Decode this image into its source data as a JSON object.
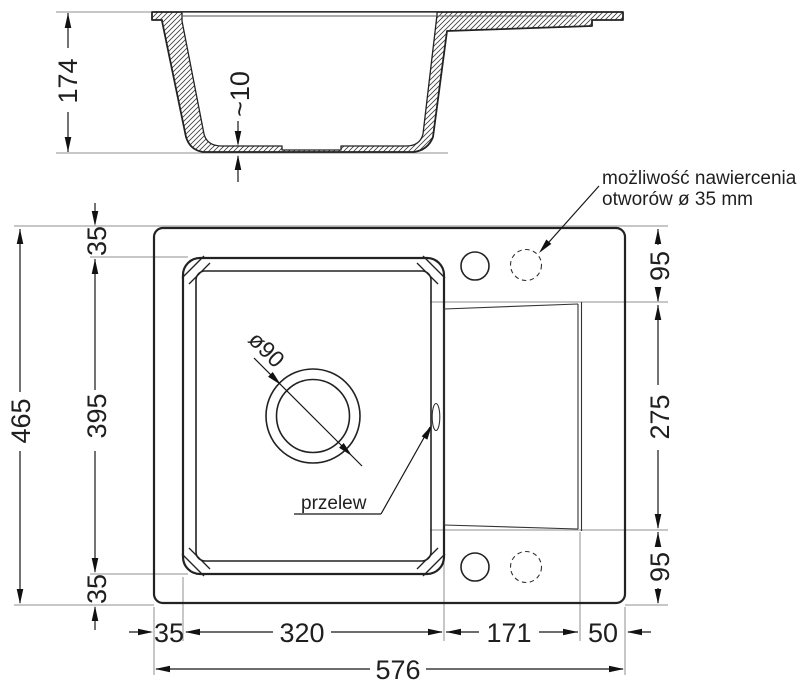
{
  "colors": {
    "ink": "#1f1f1f",
    "muted_line": "#8f8f8f",
    "background": "#ffffff"
  },
  "section_view": {
    "depth": "174",
    "floor_thickness": "~10"
  },
  "plan_view": {
    "overall_width": "576",
    "overall_depth": "465",
    "bowl_offset_top": "35",
    "bowl_depth": "395",
    "bowl_offset_bottom": "35",
    "bowl_offset_left": "35",
    "bowl_width": "320",
    "drainer_width": "171",
    "drainer_offset_right": "50",
    "drainer_offset_top": "95",
    "drainer_depth": "275",
    "drainer_offset_bottom": "95",
    "drain_diameter": "ø90",
    "overflow_label": "przelew"
  },
  "annotations": {
    "drill_note_line1": "możliwość nawiercenia",
    "drill_note_line2": "otworów ø 35 mm"
  }
}
